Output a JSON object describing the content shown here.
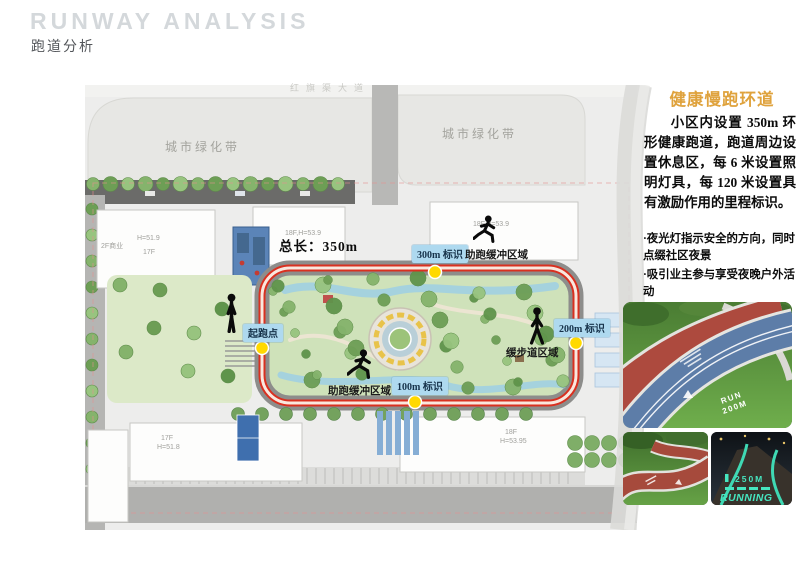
{
  "header": {
    "title_en": "RUNWAY ANALYSIS",
    "title_zh": "跑道分析"
  },
  "map": {
    "top_road_label": "红旗渠大道",
    "green_belt_left": "城市绿化带",
    "green_belt_right": "城市绿化带",
    "total_length": "总长：350m",
    "markers": {
      "start": "起跑点",
      "m100": "100m 标识",
      "m200": "200m 标识",
      "m300": "300m 标识"
    },
    "zones": {
      "buffer_top": "助跑缓冲区域",
      "buffer_bottom": "助跑缓冲区域",
      "stroll": "缓步道区域"
    },
    "buildings": {
      "nw_use": "2F商业",
      "nw_height": "H=51.9",
      "nw_floors": "17F",
      "n_mid": "18F,H=53.9",
      "ne": "18F,H=53.9",
      "sw_floors": "17F",
      "sw_height": "H=51.8",
      "se_floors": "18F",
      "se_height": "H=53.95"
    }
  },
  "sidebar": {
    "heading": "健康慢跑环道",
    "paragraph": "小区内设置 350m 环形健康跑道，跑道周边设置休息区，每 6 米设置照明灯具，每 120 米设置具有激励作用的里程标识。",
    "bullets": [
      "·夜光灯指示安全的方向，同时点缀社区夜景",
      "·吸引业主参与享受夜晚户外活动",
      "·沿路结合场地设置休息空间"
    ],
    "photos": {
      "run_label": "RUN",
      "run_distance": "200M",
      "night_distance": "250M",
      "night_label": "RUNNING"
    }
  },
  "colors": {
    "accent_orange": "#dfa23c",
    "track_red": "#d93020",
    "marker_yellow": "#ffd900",
    "label_blue_bg": "#aed9ef"
  }
}
